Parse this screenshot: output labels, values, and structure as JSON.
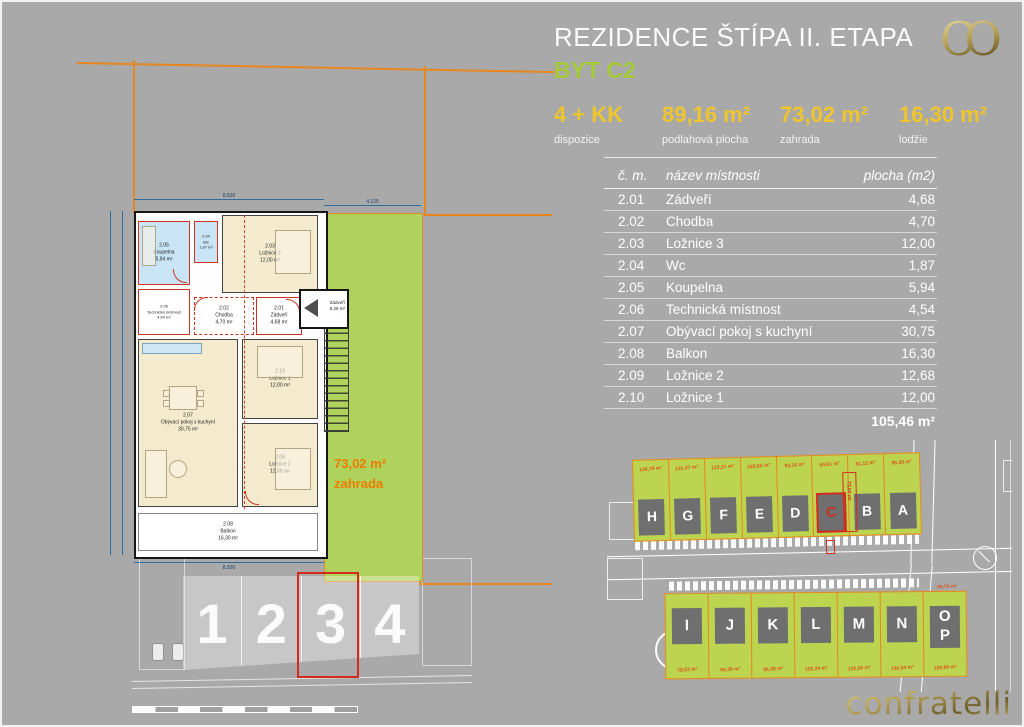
{
  "header": {
    "title": "REZIDENCE ŠTÍPA II. ETAPA",
    "subtitle": "BYT C2",
    "logo": "CO"
  },
  "stats": [
    {
      "value": "4 + KK",
      "label": "dispozice"
    },
    {
      "value": "89,16 m²",
      "label": "podlahová plocha"
    },
    {
      "value": "73,02 m²",
      "label": "zahrada"
    },
    {
      "value": "16,30 m²",
      "label": "lodžie"
    }
  ],
  "room_table": {
    "headers": {
      "num": "č. m.",
      "name": "název místnosti",
      "area": "plocha (m2)"
    },
    "rows": [
      {
        "num": "2.01",
        "name": "Zádveří",
        "area": "4,68"
      },
      {
        "num": "2.02",
        "name": "Chodba",
        "area": "4,70"
      },
      {
        "num": "2.03",
        "name": "Ložnice 3",
        "area": "12,00"
      },
      {
        "num": "2.04",
        "name": "Wc",
        "area": "1,87"
      },
      {
        "num": "2.05",
        "name": "Koupelna",
        "area": "5,94"
      },
      {
        "num": "2.06",
        "name": "Technická místnost",
        "area": "4,54"
      },
      {
        "num": "2.07",
        "name": "Obývací pokoj s kuchyní",
        "area": "30,75"
      },
      {
        "num": "2.08",
        "name": "Balkon",
        "area": "16,30"
      },
      {
        "num": "2.09",
        "name": "Ložnice 2",
        "area": "12,68"
      },
      {
        "num": "2.10",
        "name": "Ložnice 1",
        "area": "12,00"
      }
    ],
    "total": "105,46 m²"
  },
  "floorplan": {
    "rooms": {
      "koupelna": "2.05\nKoupelna\n5,94 m²",
      "wc": "2.04\nWc\n1,87 m²",
      "loznice3": "2.03\nLožnice 3\n12,00 m²",
      "tech": "2.06\nTechnická místnost\n4,54 m²",
      "chodba": "2.02\nChodba\n4,70 m²",
      "zadveri": "2.01\nZádveří\n4,68 m²",
      "vestibule": "Zádveří\n5,29 m²",
      "living": "2.07\nObývací pokoj s kuchyní\n30,75 m²",
      "loznice1": "2.10\nLožnice 1\n12,00 m²",
      "loznice2": "2.09\nLožnice 2\n12,68 m²",
      "balkon": "2.08\nBalkon\n16,30 m²"
    },
    "garden_label": "73,02 m²\nzahrada",
    "dims": {
      "top": "8.500",
      "bottom": "8.500",
      "garden_top": "4.125"
    },
    "parking": [
      {
        "label": "1"
      },
      {
        "label": "2"
      },
      {
        "label": "3",
        "highlight": true
      },
      {
        "label": "4"
      }
    ]
  },
  "siteplan": {
    "top_row": [
      {
        "letter": "H",
        "area": "136,79 m²"
      },
      {
        "letter": "G",
        "area": "131,47 m²"
      },
      {
        "letter": "F",
        "area": "123,21 m²"
      },
      {
        "letter": "E",
        "area": "165,65 m²"
      },
      {
        "letter": "D",
        "area": "93,34 m²"
      },
      {
        "letter": "C",
        "area": "94,61 m²",
        "highlight": true
      },
      {
        "letter": "B",
        "area": "81,12 m²"
      },
      {
        "letter": "A",
        "area": "85,36 m²"
      }
    ],
    "top_side_areas": [
      "75,49 m²",
      "52,21 m²",
      "63,26 m²",
      "78,81 m²",
      "77,01 m²",
      "74,58 m²",
      "111,88 m²"
    ],
    "c_garden_area": "73,02 m²",
    "bottom_row": [
      {
        "letter": "I",
        "area": "79,53 m²"
      },
      {
        "letter": "J",
        "area": "94,36 m²"
      },
      {
        "letter": "K",
        "area": "86,38 m²"
      },
      {
        "letter": "L",
        "area": "138,34 m²"
      },
      {
        "letter": "M",
        "area": "133,06 m²"
      },
      {
        "letter": "N",
        "area": "136,04 m²"
      },
      {
        "letter": "O",
        "letter2": "P",
        "area": "100,95 m²"
      }
    ],
    "bottom_side_areas": [
      "111,14 m²",
      "84,88 m²",
      "90,28 m²",
      "98,91 m²",
      "88,49 m²",
      "41,93 m²"
    ],
    "op_area": "95,79 m²"
  },
  "footer": {
    "brand": "confratelli"
  }
}
